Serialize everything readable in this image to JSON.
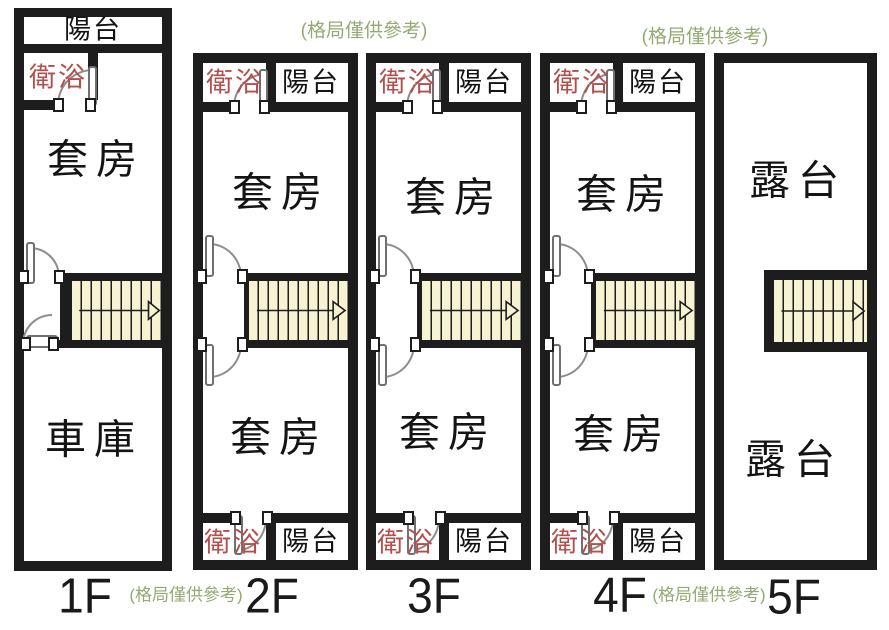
{
  "note_text": "(格局僅供參考)",
  "colors": {
    "wall": "#1d1d1d",
    "stair_fill": "#f6f3d2",
    "bath_text": "#b2504e",
    "note_text": "#93aa72",
    "room_text": "#141414",
    "background": "#ffffff"
  },
  "icons": {
    "stair_arrow": "right-arrow"
  },
  "floors": [
    {
      "label": "1F",
      "rooms": {
        "balcony": "陽台",
        "bath": "衛浴",
        "suite": "套房",
        "garage": "車庫"
      }
    },
    {
      "label": "2F",
      "rooms": {
        "bath_top": "衛浴",
        "balcony_top": "陽台",
        "suite_upper": "套房",
        "suite_lower": "套房",
        "bath_bottom": "衛浴",
        "balcony_bottom": "陽台"
      }
    },
    {
      "label": "3F",
      "rooms": {
        "bath_top": "衛浴",
        "balcony_top": "陽台",
        "suite_upper": "套房",
        "suite_lower": "套房",
        "bath_bottom": "衛浴",
        "balcony_bottom": "陽台"
      }
    },
    {
      "label": "4F",
      "rooms": {
        "bath_top": "衛浴",
        "balcony_top": "陽台",
        "suite_upper": "套房",
        "suite_lower": "套房",
        "bath_bottom": "衛浴",
        "balcony_bottom": "陽台"
      }
    },
    {
      "label": "5F",
      "rooms": {
        "terrace_upper": "露台",
        "terrace_lower": "露台"
      }
    }
  ]
}
